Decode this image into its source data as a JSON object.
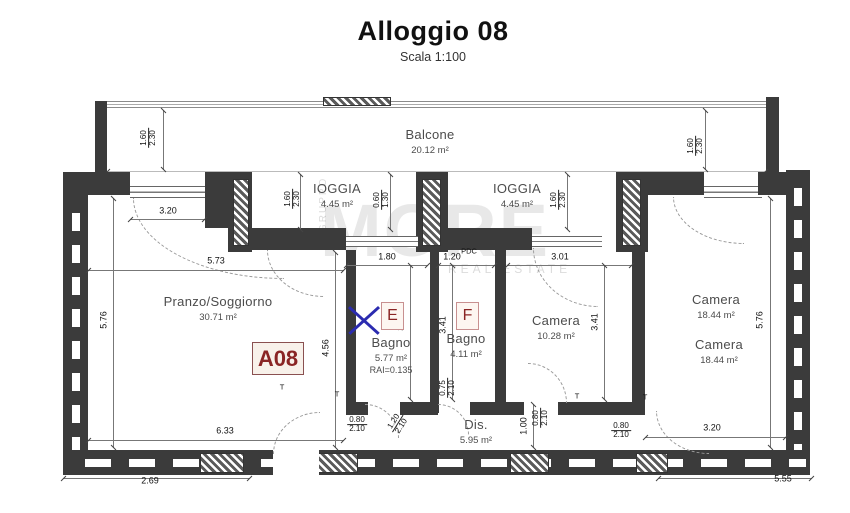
{
  "title": {
    "text": "Alloggio 08",
    "scale": "Scala 1:100"
  },
  "unit_badge": "A08",
  "badges": [
    {
      "label": "E",
      "x": 381,
      "y": 302
    },
    {
      "label": "F",
      "x": 456,
      "y": 302
    }
  ],
  "rooms": [
    {
      "name": "Balcone",
      "area": "20.12 m²",
      "x": 430,
      "y": 126
    },
    {
      "name": "IOGGIA",
      "area": "4.45 m²",
      "x": 337,
      "y": 180
    },
    {
      "name": "IOGGIA",
      "area": "4.45 m²",
      "x": 517,
      "y": 180
    },
    {
      "name": "Pranzo/Soggiorno",
      "area": "30.71 m²",
      "x": 218,
      "y": 293
    },
    {
      "name": "Bagno",
      "area": "5.77 m²",
      "extra": "RAI=0.135",
      "x": 391,
      "y": 334
    },
    {
      "name": "Bagno",
      "area": "4.11 m²",
      "x": 466,
      "y": 330
    },
    {
      "name": "Camera",
      "area": "10.28 m²",
      "x": 556,
      "y": 312
    },
    {
      "name": "Camera",
      "area": "18.44 m²",
      "x": 716,
      "y": 291
    },
    {
      "name": "Camera",
      "area": "18.44 m²",
      "x": 719,
      "y": 336
    },
    {
      "name": "Dis.",
      "area": "5.95 m²",
      "x": 476,
      "y": 416
    }
  ],
  "dimensions": [
    {
      "t": "1.60|2.30",
      "x": 149,
      "y": 138,
      "o": "v2"
    },
    {
      "t": "3.20",
      "x": 168,
      "y": 211,
      "o": "h"
    },
    {
      "t": "5.73",
      "x": 216,
      "y": 261,
      "o": "h"
    },
    {
      "t": "1.60|2.30",
      "x": 293,
      "y": 199,
      "o": "v2"
    },
    {
      "t": "0.60|1.30",
      "x": 382,
      "y": 200,
      "o": "v2"
    },
    {
      "t": "1.80",
      "x": 387,
      "y": 257,
      "o": "h"
    },
    {
      "t": "1.20",
      "x": 452,
      "y": 257,
      "o": "h"
    },
    {
      "t": "1.60|2.30",
      "x": 559,
      "y": 200,
      "o": "v2"
    },
    {
      "t": "3.01",
      "x": 560,
      "y": 257,
      "o": "h"
    },
    {
      "t": "1.60|2.30",
      "x": 696,
      "y": 146,
      "o": "v2"
    },
    {
      "t": "5.76",
      "x": 104,
      "y": 320,
      "o": "v"
    },
    {
      "t": "4.56",
      "x": 326,
      "y": 348,
      "o": "v"
    },
    {
      "t": "3.21",
      "x": 401,
      "y": 322,
      "o": "v"
    },
    {
      "t": "3.41",
      "x": 443,
      "y": 325,
      "o": "v"
    },
    {
      "t": "3.41",
      "x": 595,
      "y": 322,
      "o": "v"
    },
    {
      "t": "5.76",
      "x": 760,
      "y": 320,
      "o": "v"
    },
    {
      "t": "0.75|2.10",
      "x": 448,
      "y": 388,
      "o": "v2"
    },
    {
      "t": "0.80|2.10",
      "x": 357,
      "y": 425,
      "o": "h2"
    },
    {
      "t": "1.20|2.10",
      "x": 398,
      "y": 424,
      "o": "d2"
    },
    {
      "t": "0.80|2.10",
      "x": 541,
      "y": 418,
      "o": "v2"
    },
    {
      "t": "1.00",
      "x": 524,
      "y": 426,
      "o": "v"
    },
    {
      "t": "0.80|2.10",
      "x": 621,
      "y": 431,
      "o": "h2"
    },
    {
      "t": "6.33",
      "x": 225,
      "y": 431,
      "o": "h"
    },
    {
      "t": "2.69",
      "x": 150,
      "y": 481,
      "o": "h"
    },
    {
      "t": "3.20",
      "x": 712,
      "y": 428,
      "o": "h"
    },
    {
      "t": "5.55",
      "x": 783,
      "y": 479,
      "o": "h"
    }
  ],
  "markers": [
    {
      "text": "PDC",
      "x": 469,
      "y": 251
    },
    {
      "text": "T",
      "x": 282,
      "y": 387
    },
    {
      "text": "T",
      "x": 337,
      "y": 394
    },
    {
      "text": "T",
      "x": 577,
      "y": 396
    },
    {
      "text": "T",
      "x": 645,
      "y": 397
    }
  ],
  "watermark": {
    "big": "MORE",
    "sub": "REAL ESTATE",
    "side": "GRUPPO"
  },
  "colors": {
    "wall": "#3b3b3b",
    "badge_red": "#8a2525",
    "x_blue": "#2b2bb0",
    "arc": "#9a9a9a"
  }
}
